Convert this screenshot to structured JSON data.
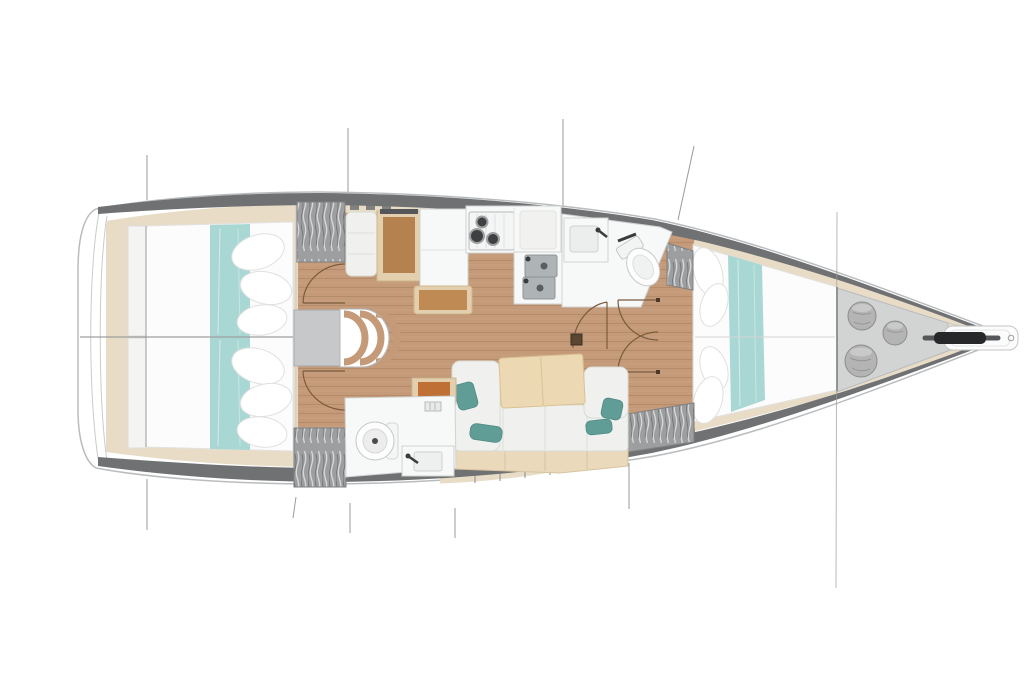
{
  "vessel": {
    "type": "sailboat-interior-floor-plan",
    "orientation": "bow-right",
    "areas": [
      {
        "name": "transom"
      },
      {
        "name": "aft cabin port"
      },
      {
        "name": "aft cabin starboard"
      },
      {
        "name": "companionway stairs"
      },
      {
        "name": "nav station"
      },
      {
        "name": "galley"
      },
      {
        "name": "aft head"
      },
      {
        "name": "salon"
      },
      {
        "name": "forward head"
      },
      {
        "name": "forward cabin"
      },
      {
        "name": "sail locker"
      },
      {
        "name": "bow anchor fitting"
      },
      {
        "name": "wardrobe"
      },
      {
        "name": "rigging lines"
      },
      {
        "name": "hull"
      }
    ],
    "features": [
      "double-berth-with-teal-runner",
      "hanging-locker",
      "three-burner-stove",
      "double-galley-sink",
      "toilet",
      "washbasin",
      "u-shaped-settee",
      "folding-salon-table",
      "chart-table",
      "companionway-steps",
      "sail-bags",
      "bowsprit-anchor-roller",
      "mast-step",
      "door-swing-arcs"
    ]
  },
  "colors": {
    "hull_stroke": "#b9bcbe",
    "bulwark": "#6f7173",
    "wood_floor": "#c49a78",
    "wood_trim": "#e8dcc6",
    "bed_white": "#fcfcfc",
    "teal_runner": "#a9d8d4",
    "teal_pillow": "#5f9d96",
    "upholstery": "#f0f1ef",
    "table_wood": "#ecd9b4",
    "desk_wood": "#b5824f",
    "frame_wood": "#e3cfae",
    "wardrobe_gray": "#9c9ea0",
    "locker_floor": "#d2d4d4",
    "sail_bag": "#b4b4b4",
    "fixture_white": "#f7f8f8",
    "stainless": "#aeb4b6",
    "anchor_dark": "#26282a",
    "door_swing": "#7b5b3e",
    "stool_orange": "#bf7034",
    "rigging": "#9b9b9b"
  }
}
